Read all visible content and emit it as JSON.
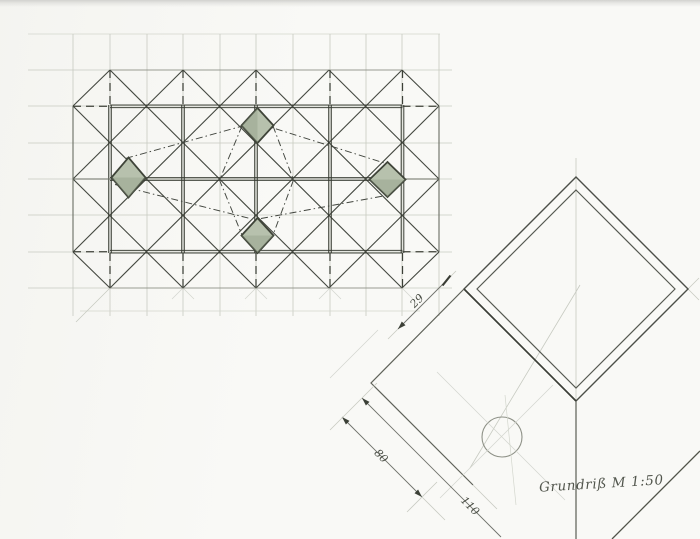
{
  "caption": {
    "text": "Grundriß M 1:50"
  },
  "dimensions": {
    "d29": "29",
    "d80": "80",
    "d110": "110"
  },
  "palette": {
    "paper": "#f9f9f6",
    "scan_edge": "#d2d2cf",
    "ink_dark": "#34382f",
    "ink_medium": "#51554c",
    "ink_light": "#6a6e63",
    "ink_faint": "#c7cac1",
    "shade_fill": "#b7c1ad",
    "shade_edge": "#3f4439"
  }
}
